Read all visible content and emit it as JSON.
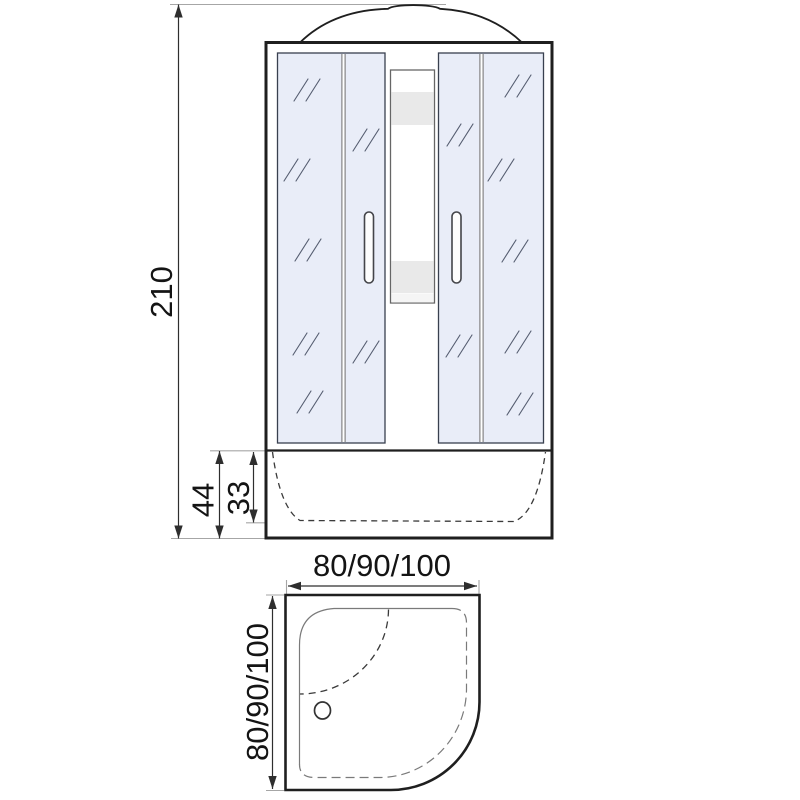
{
  "diagram": {
    "type": "technical dimension drawing",
    "subject": "corner shower cabin, front elevation and plan view",
    "views": {
      "front": {
        "overall_height": "210",
        "tray_total_height": "44",
        "tray_inner_depth": "33"
      },
      "plan": {
        "width_options": "80/90/100",
        "depth_options": "80/90/100"
      }
    }
  },
  "colors": {
    "bg": "#ffffff",
    "line": "#1f1f1f",
    "dim": "#2e2e2e",
    "ext": "#a6a6a6",
    "text": "#141414",
    "glass": "#e9edf8",
    "glass-border": "#39404f",
    "hatch": "#555d70",
    "band": "#e9e9e9",
    "band-light": "#f5f5f5"
  }
}
